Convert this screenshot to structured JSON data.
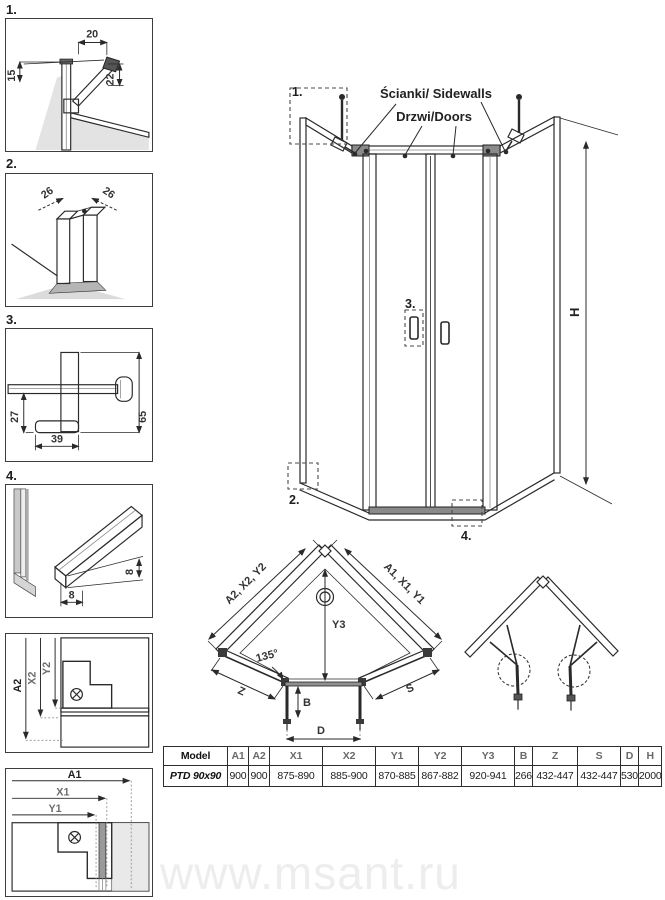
{
  "details": {
    "d1": {
      "num": "1.",
      "dim_top": "20",
      "dim_right": "22",
      "dim_left": "15"
    },
    "d2": {
      "num": "2.",
      "dim_left": "26",
      "dim_right": "26"
    },
    "d3": {
      "num": "3.",
      "dim_left": "27",
      "dim_bottom": "39",
      "dim_right": "65"
    },
    "d4": {
      "num": "4.",
      "dim_side": "8",
      "dim_bottom": "8"
    },
    "d5": {
      "dim_a2": "A2",
      "dim_x2": "X2",
      "dim_y2": "Y2"
    },
    "d6": {
      "dim_a1": "A1",
      "dim_x1": "X1",
      "dim_y1": "Y1"
    }
  },
  "front_view": {
    "sidewalls_label": "Ścianki/ Sidewalls",
    "doors_label": "Drzwi/Doors",
    "height_label": "H",
    "callout_1": "1.",
    "callout_2": "2.",
    "callout_3": "3.",
    "callout_4": "4."
  },
  "plan_view": {
    "left_edge_dims": "A2, X2, Y2",
    "right_edge_dims": "A1, X1, Y1",
    "depth": "Y3",
    "angle": "135°",
    "left_wall": "Z",
    "right_wall": "S",
    "door_offset": "B",
    "door_width": "D"
  },
  "table": {
    "headers": [
      "Model",
      "A1",
      "A2",
      "X1",
      "X2",
      "Y1",
      "Y2",
      "Y3",
      "B",
      "Z",
      "S",
      "D",
      "H"
    ],
    "row": {
      "model": "PTD 90x90",
      "values": [
        "900",
        "900",
        "875-890",
        "885-900",
        "870-885",
        "867-882",
        "920-941",
        "266",
        "432-447",
        "432-447",
        "530",
        "2000"
      ]
    }
  },
  "watermark": "www.msant.ru"
}
